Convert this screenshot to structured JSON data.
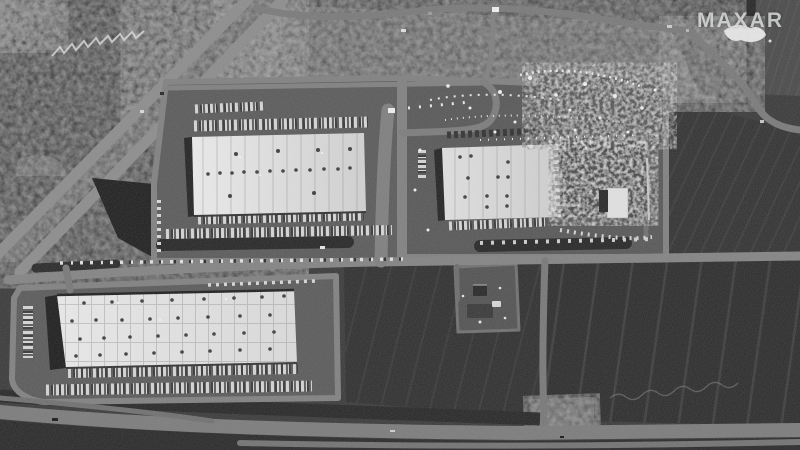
{
  "watermark": {
    "brand": "MAXAR"
  },
  "palette": {
    "field_dark": "#292929",
    "field_mid": "#333333",
    "lot_gray": "#585858",
    "road_gray": "#828282",
    "roof_white": "#e8e8e8",
    "pond_dark": "#1c1c1c",
    "debris_white": "#ededed"
  },
  "scene": {
    "kind": "grayscale satellite view",
    "landmarks": [
      "white-roof warehouse northwest",
      "warehouse northeast with destroyed east half and debris field",
      "large white-roof warehouse southwest",
      "trailer parking rows and loading docks",
      "dark plowed agricultural fields",
      "diagonal divided highway northwest corner",
      "highway along bottom edge",
      "retention ponds",
      "small damaged farmstead center-right"
    ]
  }
}
